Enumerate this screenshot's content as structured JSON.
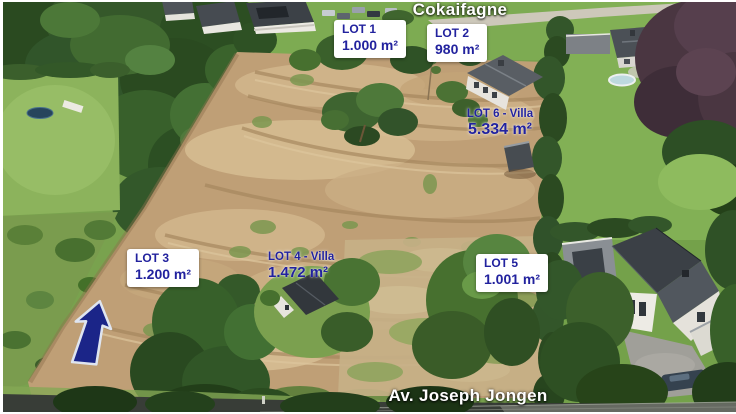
{
  "photo": {
    "description": "aerial drone view of building plots for sale",
    "street_top": "Cokaifagne",
    "street_bottom": "Av. Joseph Jongen"
  },
  "lots": [
    {
      "label": "LOT 1",
      "area": "1.000 m²"
    },
    {
      "label": "LOT 2",
      "area": "980 m²"
    },
    {
      "label": "LOT 3",
      "area": "1.200 m²"
    },
    {
      "label": "LOT 4 - Villa",
      "area": "1.472 m²"
    },
    {
      "label": "LOT 5",
      "area": "1.001 m²"
    },
    {
      "label": "LOT 6 - Villa",
      "area": "5.334 m²"
    }
  ],
  "colors": {
    "lot_text": "#22229e",
    "lot_box_bg": "#ffffff",
    "street_text": "#ffffff",
    "arrow_fill": "#1b2588"
  }
}
